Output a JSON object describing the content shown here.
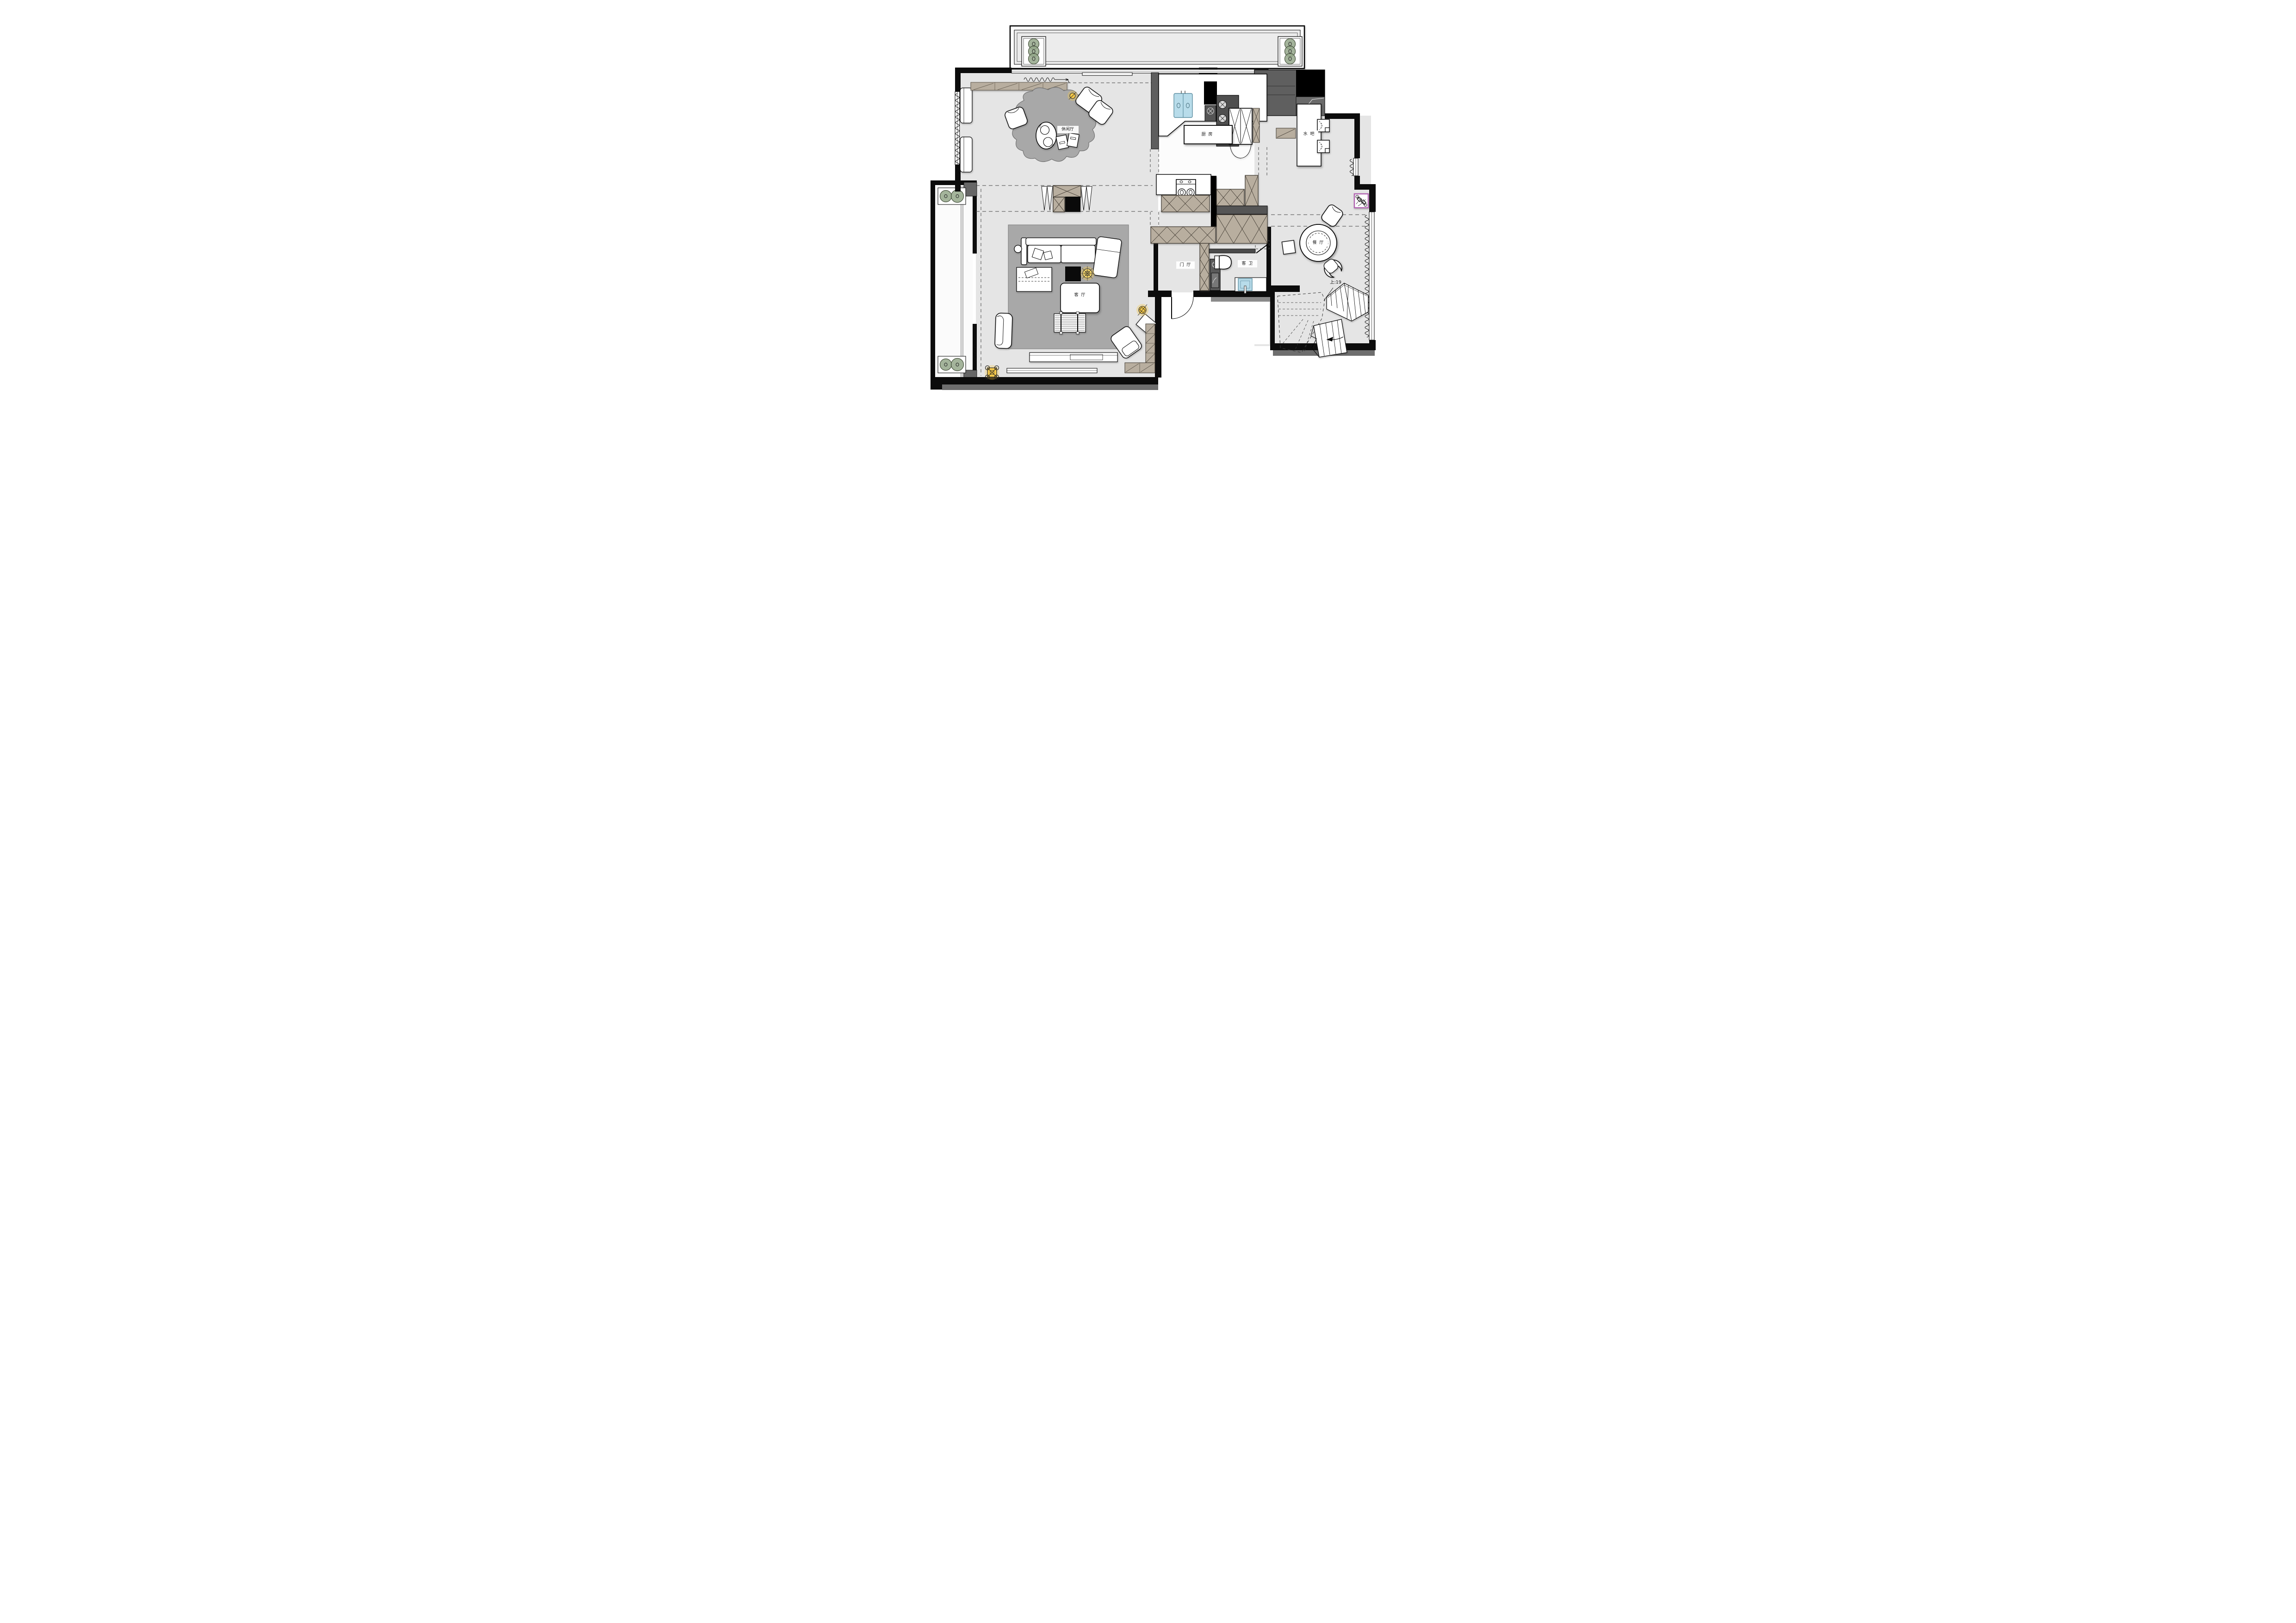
{
  "plan": {
    "rooms": [
      {
        "id": "leisure_hall",
        "label": "休闲厅"
      },
      {
        "id": "kitchen",
        "label": "厨  房"
      },
      {
        "id": "water_bar",
        "label": "水  吧"
      },
      {
        "id": "dining_room",
        "label": "餐  厅"
      },
      {
        "id": "living_room",
        "label": "客  厅"
      },
      {
        "id": "foyer",
        "label": "门  厅"
      },
      {
        "id": "guest_bath",
        "label": "客  卫"
      }
    ],
    "stairs": {
      "label": "上:19",
      "meaning": "up 19 steps"
    },
    "colors": {
      "wall": "#0c0c0c",
      "floor": "#e5e5e5",
      "kitchen_floor": "#fcfcfc",
      "rug": "#a8a8a8",
      "cabinet_tan": "#b8ae9f",
      "fixture_dark": "#575757",
      "plant_green": "#94a78a",
      "sink_blue": "#b8dcea",
      "light_yellow": "#f4c84a",
      "equipment_purple": "#b265b2"
    },
    "symbols": [
      "plant-icon",
      "sink-icon",
      "stove-burner-icon",
      "toilet-icon",
      "ceiling-light-icon",
      "curtain-icon",
      "door-swing-icon",
      "stair-arrow-icon",
      "dashed-zone-line"
    ]
  }
}
